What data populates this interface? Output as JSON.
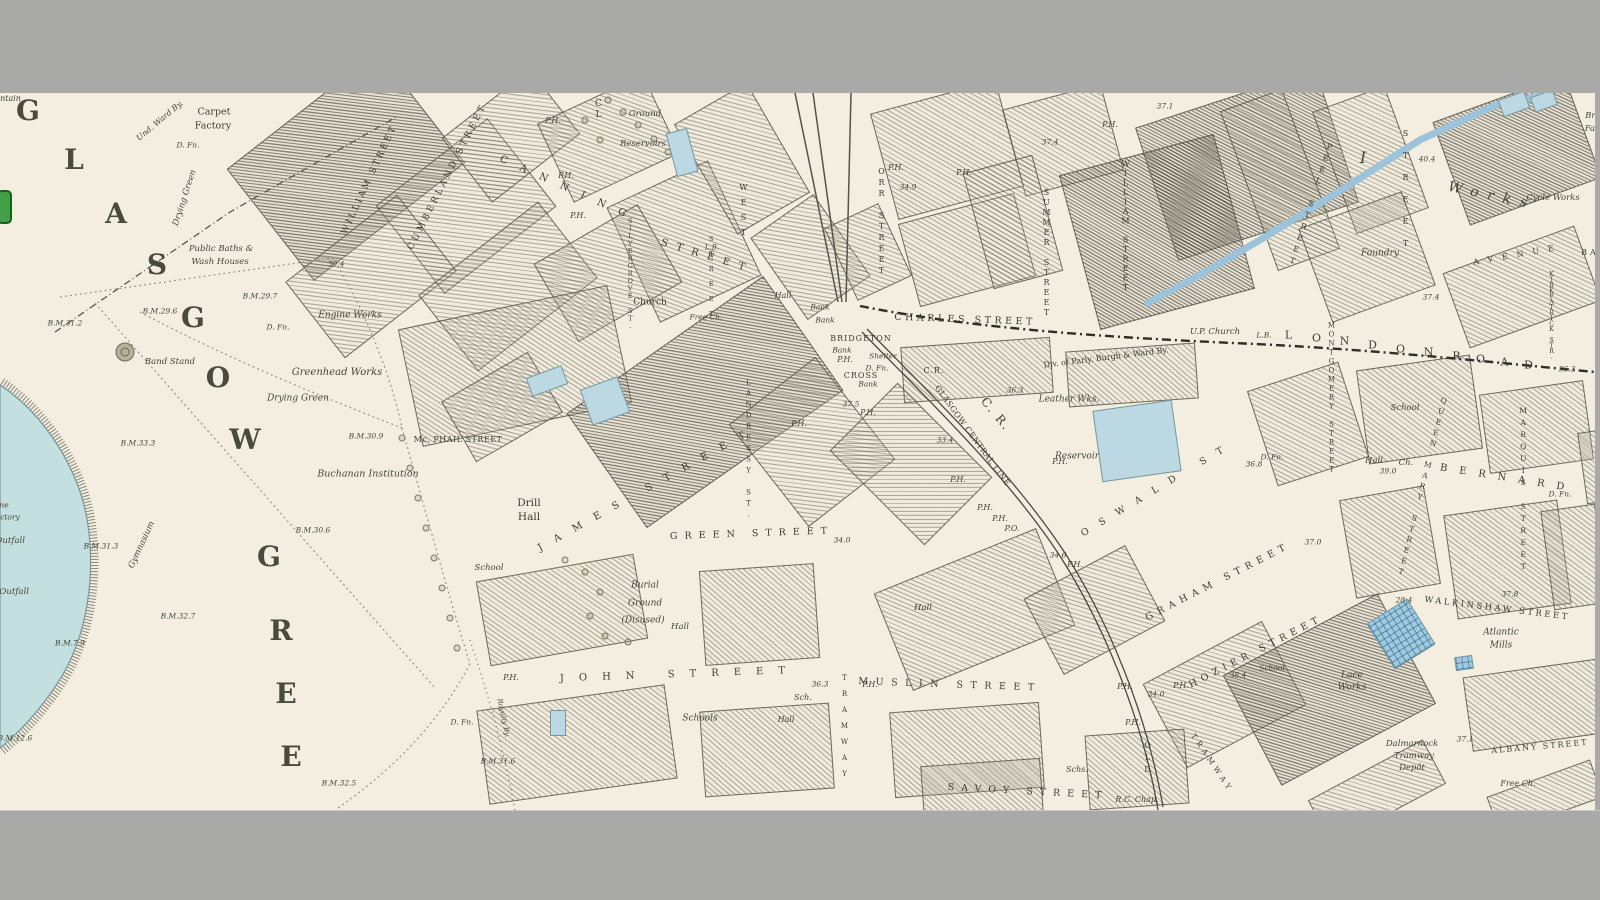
{
  "viewer": {
    "description": "historic ordnance survey town plan view, letterboxed",
    "colors": {
      "paper": "#f3eee0",
      "frame_gray": "#a9a9a7",
      "water": "#bcd9e3",
      "water_bright": "#9ecbe2",
      "hatch_ink": "#605c4e",
      "boundary_ink": "#2f2d27",
      "toggle_green": "#43a047",
      "toggle_green_border": "#1b5e20"
    }
  },
  "labels": [
    {
      "t": "G",
      "x": 28,
      "y": 111,
      "c": "g"
    },
    {
      "t": "L",
      "x": 74,
      "y": 160,
      "c": "g"
    },
    {
      "t": "A",
      "x": 116,
      "y": 214,
      "c": "g"
    },
    {
      "t": "S",
      "x": 157,
      "y": 265,
      "c": "g"
    },
    {
      "t": "G",
      "x": 193,
      "y": 318,
      "c": "g"
    },
    {
      "t": "O",
      "x": 218,
      "y": 378,
      "c": "g"
    },
    {
      "t": "W",
      "x": 245,
      "y": 440,
      "c": "g"
    },
    {
      "t": "G",
      "x": 269,
      "y": 557,
      "c": "g"
    },
    {
      "t": "R",
      "x": 281,
      "y": 631,
      "c": "g"
    },
    {
      "t": "E",
      "x": 286,
      "y": 694,
      "c": "g"
    },
    {
      "t": "E",
      "x": 291,
      "y": 757,
      "c": "g"
    },
    {
      "t": "Fountain",
      "x": 3,
      "y": 99,
      "c": "it",
      "s": 8
    },
    {
      "t": "ne",
      "x": 4,
      "y": 505,
      "c": "it",
      "s": 7.5
    },
    {
      "t": "ctory",
      "x": 10,
      "y": 517,
      "c": "it",
      "s": 7.5
    },
    {
      "t": "Sewage Outfall",
      "x": -8,
      "y": 541,
      "c": "it",
      "s": 8.5
    },
    {
      "t": "Sewage Outfall",
      "x": -4,
      "y": 592,
      "c": "it",
      "s": 8.5
    },
    {
      "t": "Und. Ward By.",
      "x": 160,
      "y": 121,
      "c": "it",
      "s": 8,
      "r": -40
    },
    {
      "t": "Carpet",
      "x": 214,
      "y": 112,
      "c": "pl",
      "s": 9.5
    },
    {
      "t": "Factory",
      "x": 213,
      "y": 126,
      "c": "pl",
      "s": 9.5
    },
    {
      "t": "D. Fn.",
      "x": 188,
      "y": 145,
      "c": "it",
      "s": 7.5
    },
    {
      "t": "Drying Green",
      "x": 185,
      "y": 198,
      "c": "it",
      "s": 8.5,
      "r": -72
    },
    {
      "t": "Public Baths &",
      "x": 221,
      "y": 249,
      "c": "it",
      "s": 8.5
    },
    {
      "t": "Wash Houses",
      "x": 220,
      "y": 262,
      "c": "it",
      "s": 8.5
    },
    {
      "t": "B.M.29.7",
      "x": 260,
      "y": 296,
      "c": "num"
    },
    {
      "t": "B.M.29.6",
      "x": 160,
      "y": 311,
      "c": "num"
    },
    {
      "t": "B.M.31.2",
      "x": 65,
      "y": 323,
      "c": "num"
    },
    {
      "t": "30.4",
      "x": 336,
      "y": 264,
      "c": "num"
    },
    {
      "t": "Engine Works",
      "x": 350,
      "y": 316,
      "c": "it",
      "s": 9
    },
    {
      "t": "Greenhead Works",
      "x": 337,
      "y": 373,
      "c": "it",
      "s": 10
    },
    {
      "t": "Drying Green",
      "x": 298,
      "y": 399,
      "c": "it",
      "s": 9
    },
    {
      "t": "Band Stand",
      "x": 170,
      "y": 362,
      "c": "it",
      "s": 8.5
    },
    {
      "t": "D. Fn.",
      "x": 278,
      "y": 327,
      "c": "it",
      "s": 7.5
    },
    {
      "t": "B.M.33.3",
      "x": 138,
      "y": 443,
      "c": "num"
    },
    {
      "t": "B.M.30.9",
      "x": 366,
      "y": 436,
      "c": "num"
    },
    {
      "t": "Buchanan Institution",
      "x": 368,
      "y": 474,
      "c": "it",
      "s": 9.5
    },
    {
      "t": "B.M.30.6",
      "x": 313,
      "y": 530,
      "c": "num"
    },
    {
      "t": "B.M.31.3",
      "x": 101,
      "y": 546,
      "c": "num"
    },
    {
      "t": "Gymnasium",
      "x": 142,
      "y": 545,
      "c": "it",
      "s": 8.5,
      "r": -65
    },
    {
      "t": "B.M.32.7",
      "x": 178,
      "y": 616,
      "c": "num"
    },
    {
      "t": "B.M.7.9",
      "x": 70,
      "y": 643,
      "c": "num"
    },
    {
      "t": "B.M.12.6",
      "x": 15,
      "y": 738,
      "c": "num"
    },
    {
      "t": "B.M.32.5",
      "x": 339,
      "y": 783,
      "c": "num"
    },
    {
      "t": "Royalty By.",
      "x": 503,
      "y": 718,
      "c": "it",
      "s": 7,
      "r": 78
    },
    {
      "t": "WILLIAM STREET",
      "x": 370,
      "y": 180,
      "c": "st",
      "r": -65,
      "ls": 2.5,
      "s": 9
    },
    {
      "t": "CUMBERLAND STREET",
      "x": 448,
      "y": 177,
      "c": "st",
      "r": -63,
      "ls": 3,
      "s": 9
    },
    {
      "t": "CANNING",
      "x": 569,
      "y": 190,
      "c": "st",
      "r": 24,
      "ls": 14,
      "s": 10
    },
    {
      "t": "STREET",
      "x": 707,
      "y": 257,
      "c": "st",
      "r": 17,
      "ls": 9,
      "s": 10
    },
    {
      "t": "P.H.",
      "x": 553,
      "y": 121,
      "c": "ph"
    },
    {
      "t": "P.H.",
      "x": 566,
      "y": 176,
      "c": "ph"
    },
    {
      "t": "P.H.",
      "x": 578,
      "y": 216,
      "c": "ph"
    },
    {
      "t": "Ground",
      "x": 645,
      "y": 114,
      "c": "it",
      "s": 8.5
    },
    {
      "t": "Reservoirs",
      "x": 643,
      "y": 144,
      "c": "it",
      "s": 8.5
    },
    {
      "t": "CL",
      "x": 598,
      "y": 110,
      "c": "stv",
      "s": 9
    },
    {
      "t": "Church",
      "x": 650,
      "y": 303,
      "c": "pl",
      "s": 9
    },
    {
      "t": "Free Ch.",
      "x": 706,
      "y": 317,
      "c": "it",
      "s": 7.5
    },
    {
      "t": "SILVERGROVE ST.",
      "x": 630,
      "y": 273,
      "c": "stv",
      "s": 6.5,
      "ls": -0.5
    },
    {
      "t": "STREET",
      "x": 711,
      "y": 280,
      "c": "stv",
      "s": 6.5,
      "ls": 7
    },
    {
      "t": "WEST",
      "x": 743,
      "y": 213,
      "c": "stv",
      "s": 8,
      "ls": 6
    },
    {
      "t": "L.B.",
      "x": 712,
      "y": 248,
      "c": "ph",
      "s": 7
    },
    {
      "t": "Hall",
      "x": 783,
      "y": 296,
      "c": "it",
      "s": 8
    },
    {
      "t": "Bank",
      "x": 820,
      "y": 307,
      "c": "it",
      "s": 7.5
    },
    {
      "t": "Bank",
      "x": 825,
      "y": 320,
      "c": "it",
      "s": 7.5
    },
    {
      "t": "BRIDGETON",
      "x": 861,
      "y": 339,
      "c": "st",
      "s": 8,
      "ls": 1
    },
    {
      "t": "Bank",
      "x": 842,
      "y": 350,
      "c": "it",
      "s": 7.5
    },
    {
      "t": "P.H.",
      "x": 845,
      "y": 360,
      "c": "ph"
    },
    {
      "t": "Shelter",
      "x": 883,
      "y": 356,
      "c": "it",
      "s": 7.5
    },
    {
      "t": "D. Fn.",
      "x": 877,
      "y": 368,
      "c": "it",
      "s": 7.5
    },
    {
      "t": "CROSS",
      "x": 861,
      "y": 376,
      "c": "st",
      "s": 8,
      "ls": 1
    },
    {
      "t": "Bank",
      "x": 868,
      "y": 384,
      "c": "it",
      "s": 7.5
    },
    {
      "t": "37.5",
      "x": 851,
      "y": 404,
      "c": "num"
    },
    {
      "t": "P.H.",
      "x": 868,
      "y": 413,
      "c": "ph"
    },
    {
      "t": "P.H.",
      "x": 799,
      "y": 424,
      "c": "ph"
    },
    {
      "t": "C.R.",
      "x": 934,
      "y": 371,
      "c": "st",
      "s": 8,
      "ls": 1
    },
    {
      "t": "36.3",
      "x": 1015,
      "y": 390,
      "c": "num"
    },
    {
      "t": "33.4",
      "x": 945,
      "y": 440,
      "c": "num"
    },
    {
      "t": "GLASGOW CENTRAL LINE",
      "x": 972,
      "y": 436,
      "c": "st",
      "r": 54,
      "ls": 0.5,
      "s": 8
    },
    {
      "t": "C. R.",
      "x": 996,
      "y": 414,
      "c": "st",
      "r": 50,
      "s": 12,
      "ls": 2
    },
    {
      "t": "ORR STREET",
      "x": 881,
      "y": 222,
      "c": "stv",
      "s": 8,
      "ls": 2
    },
    {
      "t": "P.H.",
      "x": 896,
      "y": 168,
      "c": "ph"
    },
    {
      "t": "34.9",
      "x": 908,
      "y": 187,
      "c": "num"
    },
    {
      "t": "CHARLES STREET",
      "x": 965,
      "y": 320,
      "c": "st",
      "r": 2,
      "ls": 3.5
    },
    {
      "t": "P.H.",
      "x": 964,
      "y": 173,
      "c": "ph"
    },
    {
      "t": "SUMMER STREET",
      "x": 1046,
      "y": 253,
      "c": "stv",
      "s": 8,
      "ls": 1
    },
    {
      "t": "37.4",
      "x": 1050,
      "y": 142,
      "c": "num"
    },
    {
      "t": "WILLIAM STREET",
      "x": 1125,
      "y": 226,
      "c": "stv",
      "s": 8,
      "ls": 0.5
    },
    {
      "t": "P.H.",
      "x": 1110,
      "y": 125,
      "c": "ph"
    },
    {
      "t": "37.1",
      "x": 1165,
      "y": 106,
      "c": "num"
    },
    {
      "t": "Leather Wks.",
      "x": 1069,
      "y": 400,
      "c": "it",
      "s": 9
    },
    {
      "t": "Reservoir",
      "x": 1077,
      "y": 457,
      "c": "it",
      "s": 9
    },
    {
      "t": "Div. of Parly. Burgh & Ward By.",
      "x": 1106,
      "y": 358,
      "c": "pl",
      "s": 8,
      "r": -7
    },
    {
      "t": "U.P. Church",
      "x": 1215,
      "y": 332,
      "c": "it",
      "s": 8.5
    },
    {
      "t": "L.B.",
      "x": 1264,
      "y": 335,
      "c": "ph",
      "s": 7.5
    },
    {
      "t": "L",
      "x": 1290,
      "y": 335,
      "c": "st",
      "s": 11
    },
    {
      "t": "O",
      "x": 1318,
      "y": 338,
      "c": "st",
      "s": 11
    },
    {
      "t": "N",
      "x": 1346,
      "y": 341,
      "c": "st",
      "s": 11
    },
    {
      "t": "D",
      "x": 1374,
      "y": 345,
      "c": "st",
      "s": 11
    },
    {
      "t": "O",
      "x": 1402,
      "y": 349,
      "c": "st",
      "s": 11
    },
    {
      "t": "N",
      "x": 1430,
      "y": 352,
      "c": "st",
      "s": 11
    },
    {
      "t": "R",
      "x": 1458,
      "y": 356,
      "c": "st",
      "s": 11
    },
    {
      "t": "O",
      "x": 1482,
      "y": 359,
      "c": "st",
      "s": 11
    },
    {
      "t": "A",
      "x": 1506,
      "y": 362,
      "c": "st",
      "s": 11
    },
    {
      "t": "D",
      "x": 1530,
      "y": 365,
      "c": "st",
      "s": 11
    },
    {
      "t": "36.3",
      "x": 1567,
      "y": 369,
      "c": "num"
    },
    {
      "t": "D. Fn.",
      "x": 1272,
      "y": 457,
      "c": "it",
      "s": 7.5
    },
    {
      "t": "36.8",
      "x": 1254,
      "y": 464,
      "c": "num"
    },
    {
      "t": "OSWALD ST",
      "x": 1158,
      "y": 489,
      "c": "st",
      "r": -31,
      "ls": 13,
      "s": 9.5
    },
    {
      "t": "P.H.",
      "x": 958,
      "y": 480,
      "c": "ph"
    },
    {
      "t": "P.H.",
      "x": 985,
      "y": 508,
      "c": "ph"
    },
    {
      "t": "P.H.",
      "x": 1000,
      "y": 519,
      "c": "ph"
    },
    {
      "t": "P.O.",
      "x": 1012,
      "y": 529,
      "c": "ph"
    },
    {
      "t": "P.H.",
      "x": 1060,
      "y": 462,
      "c": "ph"
    },
    {
      "t": "34.6",
      "x": 1058,
      "y": 555,
      "c": "num"
    },
    {
      "t": "P.H.",
      "x": 1075,
      "y": 565,
      "c": "ph"
    },
    {
      "t": "MONTGOMERY STREET",
      "x": 1331,
      "y": 398,
      "c": "stv",
      "s": 7,
      "ls": 1
    },
    {
      "t": "School",
      "x": 1405,
      "y": 408,
      "c": "it",
      "s": 8.5
    },
    {
      "t": "Hall",
      "x": 1374,
      "y": 461,
      "c": "it",
      "s": 8.5
    },
    {
      "t": "Ch.",
      "x": 1406,
      "y": 463,
      "c": "it",
      "s": 8.5
    },
    {
      "t": "39.0",
      "x": 1388,
      "y": 471,
      "c": "num"
    },
    {
      "t": "37.0",
      "x": 1313,
      "y": 542,
      "c": "num"
    },
    {
      "t": "QUEEN MARY STREET",
      "x": 1422,
      "y": 487,
      "c": "stv",
      "s": 7.5,
      "ls": 2,
      "r": 14
    },
    {
      "t": "MARQUIS STREET",
      "x": 1523,
      "y": 490,
      "c": "stv",
      "s": 7.5,
      "ls": 3
    },
    {
      "t": "KIRKPATRICK STR.",
      "x": 1551,
      "y": 315,
      "c": "stv",
      "s": 6,
      "ls": -1.5
    },
    {
      "t": "BERNARD",
      "x": 1508,
      "y": 479,
      "c": "st",
      "r": 9,
      "ls": 12,
      "s": 10
    },
    {
      "t": "D. Fn.",
      "x": 1560,
      "y": 494,
      "c": "it",
      "s": 7.5
    },
    {
      "t": "28.4",
      "x": 1404,
      "y": 600,
      "c": "num"
    },
    {
      "t": "37.8",
      "x": 1510,
      "y": 594,
      "c": "num"
    },
    {
      "t": "WALKINSHAW STREET",
      "x": 1497,
      "y": 609,
      "c": "st",
      "r": 7,
      "ls": 2.5,
      "s": 8.5
    },
    {
      "t": "Atlantic",
      "x": 1501,
      "y": 633,
      "c": "it",
      "s": 9
    },
    {
      "t": "Mills",
      "x": 1501,
      "y": 646,
      "c": "it",
      "s": 9
    },
    {
      "t": "PEEL STREET",
      "x": 1310,
      "y": 205,
      "c": "stv",
      "s": 8,
      "ls": 3,
      "r": 18
    },
    {
      "t": "STREET",
      "x": 1405,
      "y": 195,
      "c": "stv",
      "s": 8,
      "ls": 13
    },
    {
      "t": "40.4",
      "x": 1427,
      "y": 159,
      "c": "num"
    },
    {
      "t": "Foundry",
      "x": 1380,
      "y": 254,
      "c": "it",
      "s": 9
    },
    {
      "t": "I",
      "x": 1363,
      "y": 158,
      "c": "it",
      "s": 16
    },
    {
      "t": "Works",
      "x": 1492,
      "y": 196,
      "c": "it",
      "s": 14,
      "ls": 9,
      "r": 12
    },
    {
      "t": "Cycle Works",
      "x": 1553,
      "y": 198,
      "c": "it",
      "s": 8.5
    },
    {
      "t": "Brook",
      "x": 1598,
      "y": 116,
      "c": "it",
      "s": 8.5
    },
    {
      "t": "Factory",
      "x": 1601,
      "y": 129,
      "c": "it",
      "s": 8.5
    },
    {
      "t": "AVENUE",
      "x": 1518,
      "y": 255,
      "c": "st",
      "r": -10,
      "ls": 9,
      "s": 8
    },
    {
      "t": "BA",
      "x": 1590,
      "y": 253,
      "c": "st",
      "s": 8
    },
    {
      "t": "37.4",
      "x": 1431,
      "y": 297,
      "c": "num"
    },
    {
      "t": "Mc. PHAIL STREET",
      "x": 458,
      "y": 440,
      "c": "st",
      "s": 8,
      "ls": 0.5
    },
    {
      "t": "LANDRESSY ST.",
      "x": 748,
      "y": 450,
      "c": "stv",
      "s": 7,
      "ls": 3
    },
    {
      "t": "Drill",
      "x": 529,
      "y": 503,
      "c": "pl",
      "s": 10.5
    },
    {
      "t": "Hall",
      "x": 529,
      "y": 517,
      "c": "pl",
      "s": 10.5
    },
    {
      "t": "School",
      "x": 489,
      "y": 568,
      "c": "it",
      "s": 8.5
    },
    {
      "t": "JAMES STREET",
      "x": 648,
      "y": 489,
      "c": "st",
      "r": -29,
      "ls": 14,
      "s": 10
    },
    {
      "t": "GREEN STREET",
      "x": 752,
      "y": 534,
      "c": "st",
      "r": -2,
      "ls": 7
    },
    {
      "t": "34.0",
      "x": 842,
      "y": 540,
      "c": "num"
    },
    {
      "t": "Burial",
      "x": 645,
      "y": 586,
      "c": "it",
      "s": 9
    },
    {
      "t": "Ground",
      "x": 645,
      "y": 604,
      "c": "it",
      "s": 9
    },
    {
      "t": "(Disused)",
      "x": 643,
      "y": 621,
      "c": "it",
      "s": 9
    },
    {
      "t": "Hall",
      "x": 680,
      "y": 627,
      "c": "it",
      "s": 8.5
    },
    {
      "t": "P.H.",
      "x": 511,
      "y": 678,
      "c": "ph"
    },
    {
      "t": "JOHN STREET",
      "x": 680,
      "y": 675,
      "c": "st",
      "r": -2,
      "ls": 15,
      "s": 10
    },
    {
      "t": "36.3",
      "x": 820,
      "y": 684,
      "c": "num"
    },
    {
      "t": "D. Fn.",
      "x": 462,
      "y": 722,
      "c": "it",
      "s": 7.5
    },
    {
      "t": "B.M.31.6",
      "x": 498,
      "y": 761,
      "c": "num"
    },
    {
      "t": "Schools",
      "x": 700,
      "y": 719,
      "c": "it",
      "s": 9
    },
    {
      "t": "Sch.",
      "x": 803,
      "y": 698,
      "c": "it",
      "s": 8
    },
    {
      "t": "Hall",
      "x": 786,
      "y": 720,
      "c": "it",
      "s": 8
    },
    {
      "t": "Hall",
      "x": 923,
      "y": 608,
      "c": "it",
      "s": 8.5
    },
    {
      "t": "TRAMWAY",
      "x": 844,
      "y": 730,
      "c": "stv",
      "s": 7,
      "ls": 8
    },
    {
      "t": "P.H.",
      "x": 870,
      "y": 685,
      "c": "ph"
    },
    {
      "t": "MUSLIN STREET",
      "x": 950,
      "y": 685,
      "c": "st",
      "r": 2,
      "ls": 7.5,
      "s": 9.5
    },
    {
      "t": "SAVOY STREET",
      "x": 1028,
      "y": 792,
      "c": "st",
      "r": 3,
      "ls": 7
    },
    {
      "t": "R.C. Chap.",
      "x": 1137,
      "y": 800,
      "c": "it",
      "s": 8
    },
    {
      "t": "GRAHAM STREET",
      "x": 1218,
      "y": 582,
      "c": "st",
      "r": -27,
      "ls": 5.5
    },
    {
      "t": "HOZIER STREET",
      "x": 1256,
      "y": 652,
      "c": "st",
      "r": -27,
      "ls": 5
    },
    {
      "t": "School",
      "x": 1272,
      "y": 668,
      "c": "it",
      "s": 7.5
    },
    {
      "t": "38.4",
      "x": 1238,
      "y": 675,
      "c": "num"
    },
    {
      "t": "P.H.",
      "x": 1125,
      "y": 687,
      "c": "ph"
    },
    {
      "t": "P.H.",
      "x": 1181,
      "y": 686,
      "c": "ph"
    },
    {
      "t": "34.0",
      "x": 1156,
      "y": 694,
      "c": "num"
    },
    {
      "t": "P.H.",
      "x": 1133,
      "y": 723,
      "c": "ph"
    },
    {
      "t": "OLD",
      "x": 1147,
      "y": 759,
      "c": "stv",
      "s": 8,
      "ls": 3
    },
    {
      "t": "TRAMWAY",
      "x": 1212,
      "y": 763,
      "c": "st",
      "r": 56,
      "ls": 4,
      "s": 7.5
    },
    {
      "t": "Schs.",
      "x": 1077,
      "y": 770,
      "c": "it",
      "s": 8
    },
    {
      "t": "Lace",
      "x": 1352,
      "y": 676,
      "c": "it",
      "s": 9
    },
    {
      "t": "Works",
      "x": 1352,
      "y": 688,
      "c": "it",
      "s": 9
    },
    {
      "t": "Dalmarnock",
      "x": 1412,
      "y": 744,
      "c": "it",
      "s": 8.5
    },
    {
      "t": "Tramway",
      "x": 1414,
      "y": 756,
      "c": "it",
      "s": 8.5
    },
    {
      "t": "Depôt",
      "x": 1412,
      "y": 768,
      "c": "it",
      "s": 8.5
    },
    {
      "t": "37.1",
      "x": 1465,
      "y": 739,
      "c": "num"
    },
    {
      "t": "ALBANY STREET",
      "x": 1540,
      "y": 747,
      "c": "st",
      "r": -5,
      "ls": 2,
      "s": 8
    },
    {
      "t": "Free Ch.",
      "x": 1518,
      "y": 784,
      "c": "it",
      "s": 8
    }
  ]
}
